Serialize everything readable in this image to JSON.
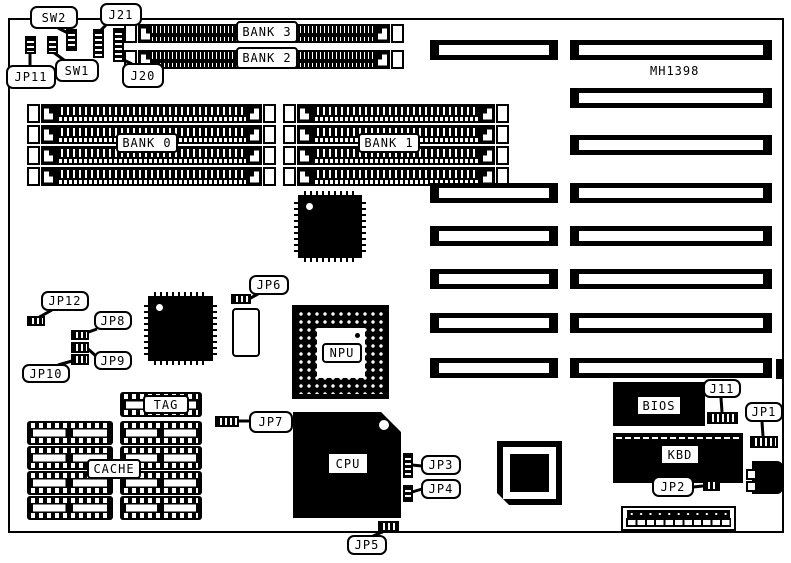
{
  "board": {
    "model": "MH1398"
  },
  "memory_banks": {
    "bank0": "BANK 0",
    "bank1": "BANK 1",
    "bank2": "BANK 2",
    "bank3": "BANK 3"
  },
  "chips": {
    "cpu": "CPU",
    "npu": "NPU",
    "tag": "TAG",
    "cache": "CACHE",
    "bios": "BIOS",
    "kbd": "KBD"
  },
  "jumpers": {
    "jp1": "JP1",
    "jp2": "JP2",
    "jp3": "JP3",
    "jp4": "JP4",
    "jp5": "JP5",
    "jp6": "JP6",
    "jp7": "JP7",
    "jp8": "JP8",
    "jp9": "JP9",
    "jp10": "JP10",
    "jp11": "JP11",
    "jp12": "JP12",
    "j11": "J11",
    "j20": "J20",
    "j21": "J21"
  },
  "switches": {
    "sw1": "SW1",
    "sw2": "SW2"
  }
}
